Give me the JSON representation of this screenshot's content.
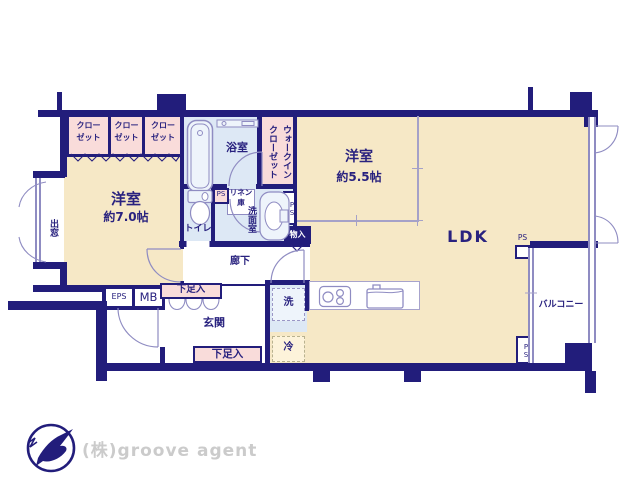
{
  "colors": {
    "wall": "#221d7b",
    "floor_room": "#f6e8c6",
    "floor_wet": "#dde8f5",
    "closet_pink": "#f9dcda",
    "partition_line": "#8f8cc2",
    "text_navy": "#29227f",
    "logo_text": "#cbcbcb"
  },
  "rooms": {
    "western7": {
      "name": "洋室",
      "size": "約7.0帖"
    },
    "western55": {
      "name": "洋室",
      "size": "約5.5帖"
    },
    "ldk": {
      "name": "LDK"
    },
    "bath": {
      "name": "浴室"
    },
    "toilet": {
      "name": "トイレ"
    },
    "washroom": {
      "name": "洗面室"
    },
    "hallway": {
      "name": "廊下"
    },
    "entrance": {
      "name": "玄関"
    },
    "balcony": {
      "name": "バルコニー"
    }
  },
  "storage": {
    "closets": [
      {
        "line1": "クロー",
        "line2": "ゼット"
      },
      {
        "line1": "クロー",
        "line2": "ゼット"
      },
      {
        "line1": "クロー",
        "line2": "ゼット"
      }
    ],
    "walk_in": {
      "line1": "ウォークイン",
      "line2": "クローゼット"
    },
    "linen": {
      "line1": "リネン",
      "line2": "庫"
    },
    "storage_box": "物入",
    "shoe_upper": "下足入",
    "shoe_lower": "下足入"
  },
  "fixtures": {
    "washer": "洗",
    "fridge": "冷"
  },
  "shafts": {
    "ps_linen": "PS",
    "ps_washroom": "PS",
    "ps_ldk": "PS",
    "ps_balcony": "PS",
    "eps": "EPS",
    "mb": "MB"
  },
  "windows": {
    "bay": "出窓"
  },
  "branding": {
    "company": "(株)groove agent"
  }
}
